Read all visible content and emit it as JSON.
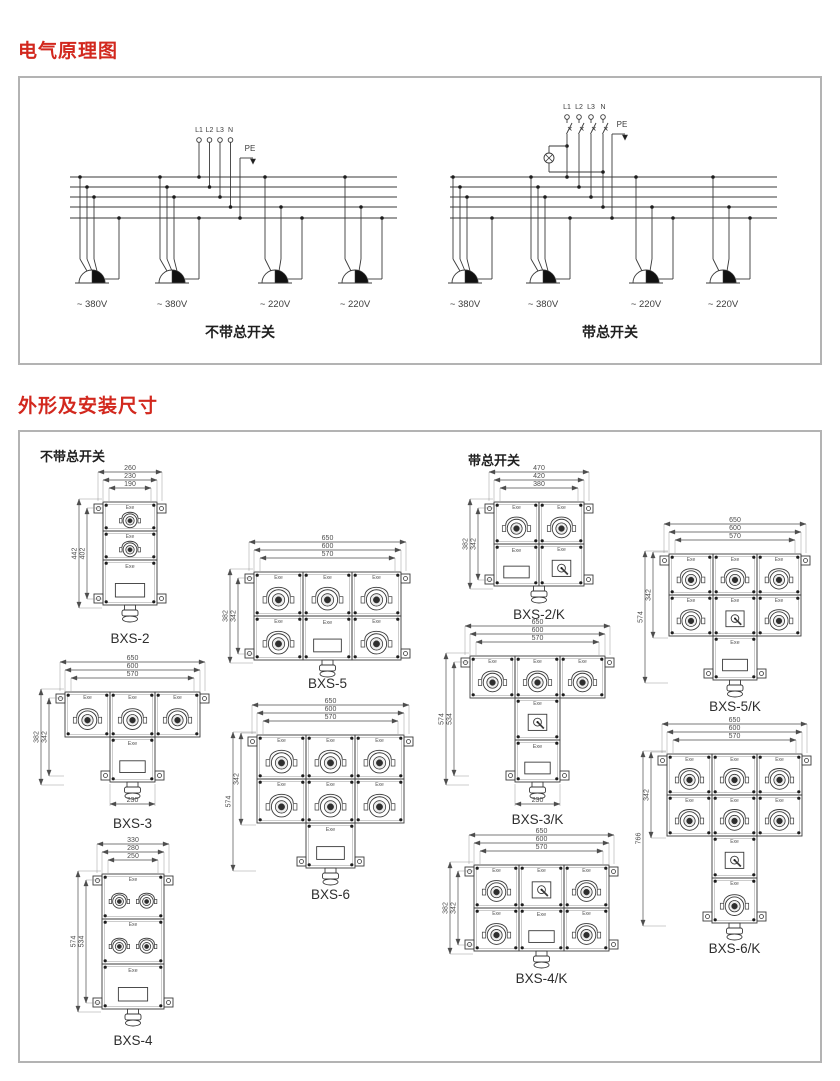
{
  "colors": {
    "accent_red": "#d2281e",
    "line": "#3a3a3a",
    "dim": "#4d4d4d",
    "panel_border": "#b3b3b3"
  },
  "section1": {
    "title": "电气原理图",
    "left": {
      "terminals": [
        "L1",
        "L2",
        "L3",
        "N"
      ],
      "pe_label": "PE",
      "voltages": [
        "~ 380V",
        "~ 380V",
        "~ 220V",
        "~ 220V"
      ],
      "caption": "不带总开关",
      "main_switch": false
    },
    "right": {
      "terminals": [
        "L1",
        "L2",
        "L3",
        "N"
      ],
      "pe_label": "PE",
      "voltages": [
        "~ 380V",
        "~ 380V",
        "~ 220V",
        "~ 220V"
      ],
      "caption": "带总开关",
      "main_switch": true
    }
  },
  "section2": {
    "title": "外形及安装尺寸",
    "left_group_label": "不带总开关",
    "right_group_label": "带总开关",
    "exe_label": "Exe",
    "drawings": [
      {
        "model": "BXS-2",
        "group": "left",
        "top_dims": [
          "260",
          "230",
          "190"
        ],
        "side_dims": [
          "442",
          "402"
        ],
        "side_dim_spans": [
          "full",
          "trim"
        ],
        "bottom_dim": null,
        "grid": [
          [
            "S"
          ],
          [
            "S"
          ],
          [
            "T"
          ]
        ]
      },
      {
        "model": "BXS-3",
        "group": "left",
        "top_dims": [
          "650",
          "600",
          "570"
        ],
        "side_dims": [
          "382",
          "342"
        ],
        "side_dim_spans": [
          "full",
          "trim"
        ],
        "bottom_dim": "230",
        "grid": [
          [
            "S",
            "S",
            "S"
          ],
          [
            null,
            "T",
            null
          ]
        ]
      },
      {
        "model": "BXS-4",
        "group": "left",
        "top_dims": [
          "330",
          "280",
          "250"
        ],
        "side_dims": [
          "574",
          "534"
        ],
        "side_dim_spans": [
          "full",
          "trim"
        ],
        "bottom_dim": null,
        "grid": [
          [
            "S2"
          ],
          [
            "S2"
          ],
          [
            "T"
          ]
        ]
      },
      {
        "model": "BXS-5",
        "group": "left",
        "top_dims": [
          "650",
          "600",
          "570"
        ],
        "side_dims": [
          "382",
          "342"
        ],
        "side_dim_spans": [
          "full",
          "trim"
        ],
        "bottom_dim": null,
        "grid": [
          [
            "S",
            "S",
            "S"
          ],
          [
            "S",
            "T",
            "S"
          ]
        ]
      },
      {
        "model": "BXS-6",
        "group": "left",
        "top_dims": [
          "650",
          "600",
          "570"
        ],
        "side_dims": [
          "574",
          "342"
        ],
        "side_dim_spans": [
          "full",
          "rows2"
        ],
        "bottom_dim": null,
        "grid": [
          [
            "S",
            "S",
            "S"
          ],
          [
            "S",
            "S",
            "S"
          ],
          [
            null,
            "T",
            null
          ]
        ]
      },
      {
        "model": "BXS-2/K",
        "group": "right",
        "top_dims": [
          "470",
          "420",
          "380"
        ],
        "side_dims": [
          "382",
          "342"
        ],
        "side_dim_spans": [
          "full",
          "trim"
        ],
        "bottom_dim": null,
        "grid": [
          [
            "S",
            "S"
          ],
          [
            "T",
            "K"
          ]
        ]
      },
      {
        "model": "BXS-3/K",
        "group": "right",
        "top_dims": [
          "650",
          "600",
          "570"
        ],
        "side_dims": [
          "574",
          "534"
        ],
        "side_dim_spans": [
          "full",
          "trim"
        ],
        "bottom_dim": "230",
        "grid": [
          [
            "S",
            "S",
            "S"
          ],
          [
            null,
            "K",
            null
          ],
          [
            null,
            "T",
            null
          ]
        ]
      },
      {
        "model": "BXS-4/K",
        "group": "right",
        "top_dims": [
          "650",
          "600",
          "570"
        ],
        "side_dims": [
          "382",
          "342"
        ],
        "side_dim_spans": [
          "full",
          "trim"
        ],
        "bottom_dim": null,
        "grid": [
          [
            "S",
            "K",
            "S"
          ],
          [
            "S",
            "T",
            "S"
          ]
        ]
      },
      {
        "model": "BXS-5/K",
        "group": "right",
        "top_dims": [
          "650",
          "600",
          "570"
        ],
        "side_dims": [
          "574",
          "342"
        ],
        "side_dim_spans": [
          "full",
          "rows2"
        ],
        "bottom_dim": null,
        "grid": [
          [
            "S",
            "S",
            "S"
          ],
          [
            "S",
            "K",
            "S"
          ],
          [
            null,
            "T",
            null
          ]
        ]
      },
      {
        "model": "BXS-6/K",
        "group": "right",
        "top_dims": [
          "650",
          "600",
          "570"
        ],
        "side_dims": [
          "766",
          "342"
        ],
        "side_dim_spans": [
          "full",
          "rows2"
        ],
        "bottom_dim": null,
        "grid": [
          [
            "S",
            "S",
            "S"
          ],
          [
            "S",
            "S",
            "S"
          ],
          [
            null,
            "K",
            null
          ],
          [
            null,
            "S",
            null
          ]
        ]
      }
    ]
  }
}
